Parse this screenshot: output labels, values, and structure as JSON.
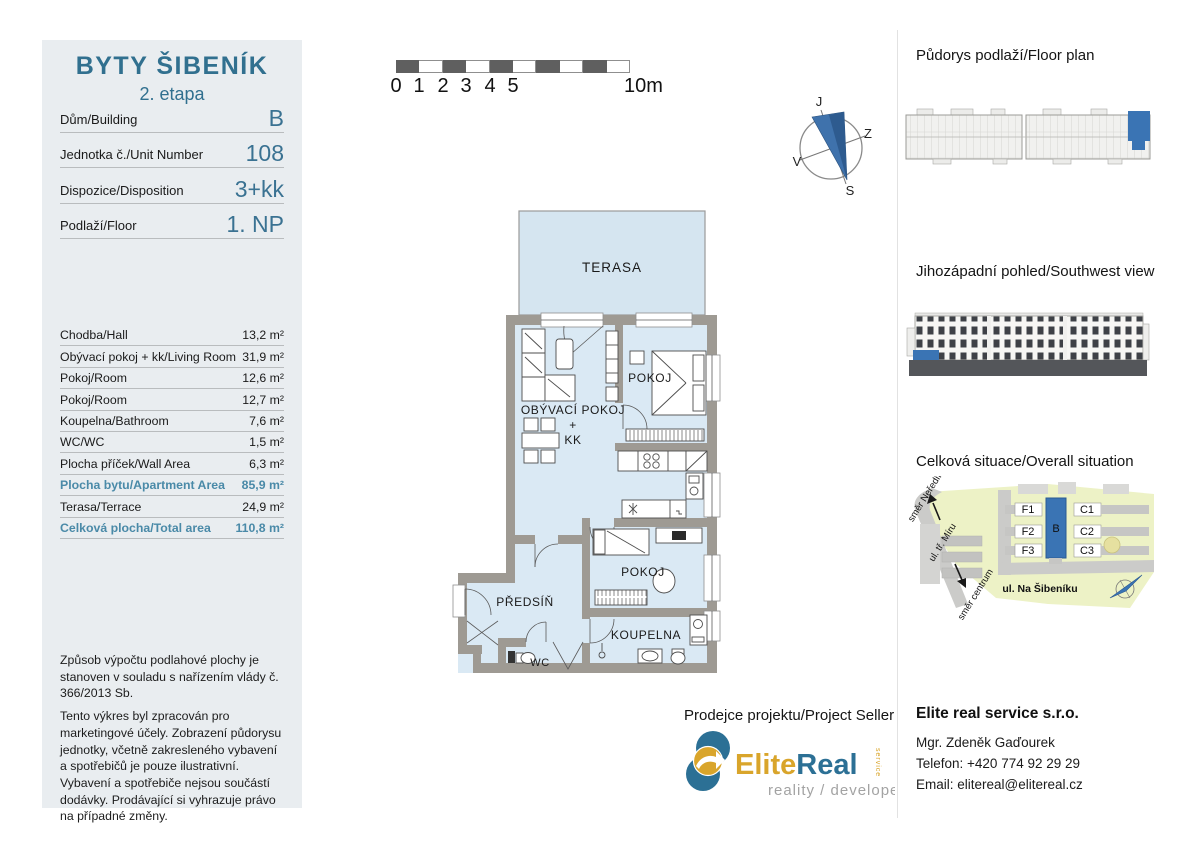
{
  "colors": {
    "teal": "#31708f",
    "value-blue": "#3a7292",
    "highlight": "#4a8aa8",
    "sidebar-bg": "#e9edf0",
    "wall": "#9e9a93",
    "room": "#dae9f4",
    "terrace": "#d5e5f0",
    "accent-blue": "#3a74b4",
    "gold": "#d9a52b",
    "logo-teal": "#2c7095",
    "scale-dark": "#5f5f5f",
    "site-green": "#edf2c6",
    "site-gray": "#cbcbc9",
    "elev-dark": "#54565a"
  },
  "sidebar": {
    "title": "BYTY ŠIBENÍK",
    "subtitle": "2. etapa",
    "unit_info": [
      {
        "label": "Dům/Building",
        "value": "B"
      },
      {
        "label": "Jednotka č./Unit Number",
        "value": "108"
      },
      {
        "label": "Dispozice/Disposition",
        "value": "3+kk"
      },
      {
        "label": "Podlaží/Floor",
        "value": "1. NP"
      }
    ],
    "areas": [
      {
        "label": "Chodba/Hall",
        "value": "13,2 m²"
      },
      {
        "label": "Obývací pokoj + kk/Living Room",
        "value": "31,9 m²"
      },
      {
        "label": "Pokoj/Room",
        "value": "12,6 m²"
      },
      {
        "label": "Pokoj/Room",
        "value": "12,7 m²"
      },
      {
        "label": "Koupelna/Bathroom",
        "value": "7,6 m²"
      },
      {
        "label": "WC/WC",
        "value": "1,5 m²"
      },
      {
        "label": "Plocha příček/Wall Area",
        "value": "6,3 m²"
      },
      {
        "label": "Plocha bytu/Apartment Area",
        "value": "85,9 m²"
      },
      {
        "label": "Terasa/Terrace",
        "value": "24,9 m²"
      },
      {
        "label": "Celková plocha/Total area",
        "value": "110,8 m²"
      }
    ],
    "disclaimer1": "Způsob výpočtu podlahové plochy je stanoven v souladu s nařízením vlády č. 366/2013 Sb.",
    "disclaimer2": "Tento výkres byl zpracován pro marketingové účely. Zobrazení půdorysu jednotky, včetně zakresleného vybavení a spotřebičů je pouze ilustrativní. Vybavení a spotřebiče nejsou součástí dodávky. Prodávající si vyhrazuje právo na případné změny."
  },
  "scale": {
    "labels": [
      "0",
      "1",
      "2",
      "3",
      "4",
      "5"
    ],
    "end": "10m"
  },
  "compass": {
    "top": "J",
    "right": "Z",
    "bottom": "S",
    "left": "V"
  },
  "floor_plan": {
    "terrace": "TERASA",
    "living_1": "OBÝVACÍ POKOJ",
    "living_2": "+",
    "living_3": "KK",
    "bedroom1": "POKOJ",
    "bedroom2": "POKOJ",
    "hall": "PŘEDSÍŇ",
    "bathroom": "KOUPELNA",
    "wc": "WC"
  },
  "right_panel": {
    "floor_plan_heading": "Půdorys podlaží/Floor plan",
    "view_heading": "Jihozápadní pohled/Southwest view",
    "situation_heading": "Celková situace/Overall situation",
    "situation": {
      "f1": "F1",
      "f2": "F2",
      "f3": "F3",
      "b": "B",
      "c1": "C1",
      "c2": "C2",
      "c3": "C3",
      "street_bottom": "ul. Na Šibeníku",
      "street_left": "ul. tř. Míru",
      "dir_north": "směr Neředín",
      "dir_south": "směr centrum"
    }
  },
  "seller": {
    "heading": "Prodejce projektu/Project Seller",
    "company": "Elite real service s.r.o.",
    "contact": "Mgr. Zdeněk Gaďourek",
    "phone": "Telefon: +420 774 92 29 29",
    "email": "Email: elitereal@elitereal.cz",
    "logo": {
      "part1": "Elite",
      "part2": "Real",
      "part3": "service",
      "tagline": "reality / developer"
    }
  }
}
